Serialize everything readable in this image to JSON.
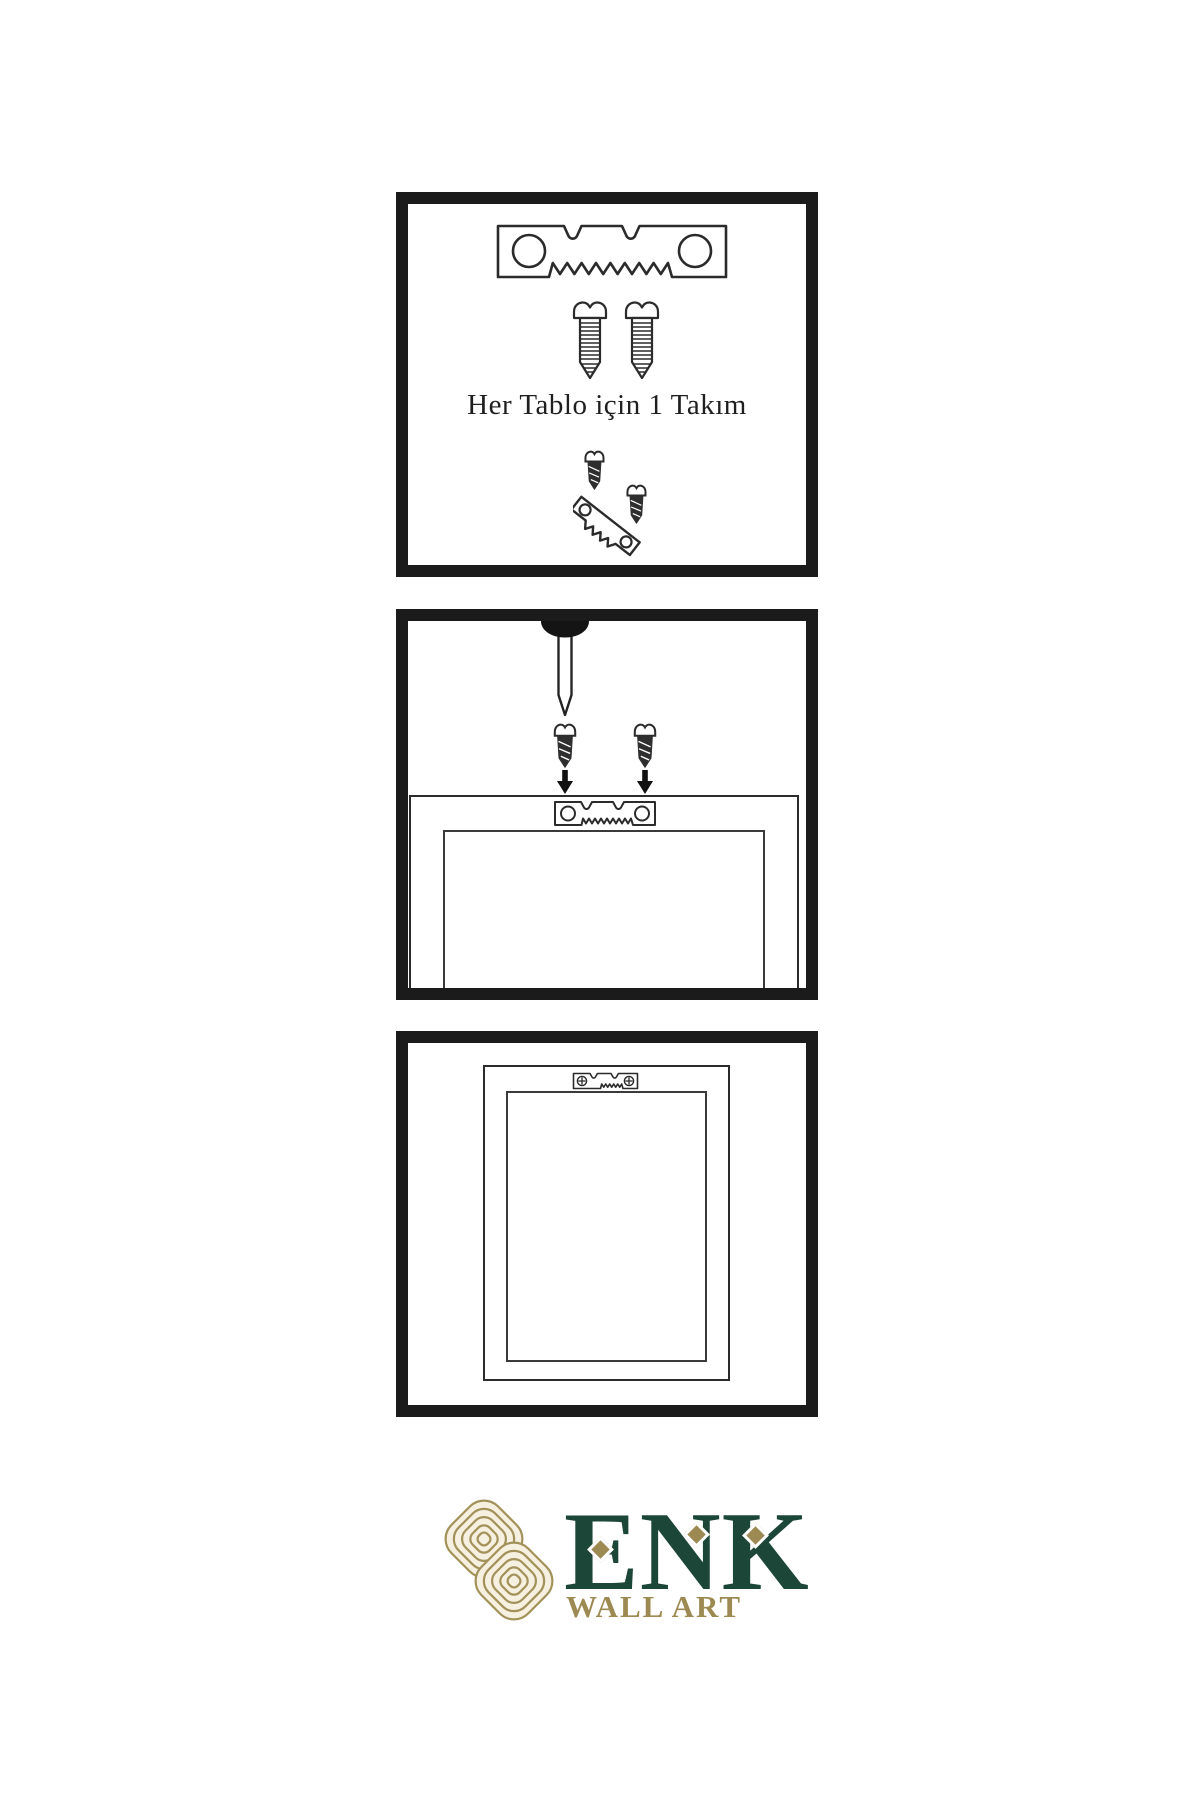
{
  "page": {
    "background": "#ffffff",
    "width": 1200,
    "height": 1800
  },
  "colors": {
    "panel_border": "#1b1b1b",
    "line_art": "#2b2b2b",
    "dark_hardware": "#2e2e2e",
    "logo_green": "#1c4638",
    "logo_gold": "#9d8a52",
    "logo_gold_line": "#a29158",
    "logo_cream": "#f6f0e0"
  },
  "steps": [
    {
      "name": "hardware-kit",
      "caption": "Her Tablo için 1 Takım",
      "icons": [
        "sawtooth-hanger-icon",
        "screw-icon",
        "screw-icon",
        "hanger-assembly-detail-icon"
      ]
    },
    {
      "name": "mount-hanger-on-frame",
      "icons": [
        "wall-nail-icon",
        "dark-screw-icon",
        "dark-screw-icon",
        "down-arrow-icon",
        "down-arrow-icon",
        "sawtooth-hanger-icon",
        "frame-back-icon"
      ]
    },
    {
      "name": "hang-frame",
      "icons": [
        "frame-back-icon",
        "mounted-sawtooth-hanger-icon"
      ]
    }
  ],
  "logo": {
    "emblem": "knot-emblem-icon",
    "brand": "ENK",
    "subtitle": "WALL ART"
  }
}
